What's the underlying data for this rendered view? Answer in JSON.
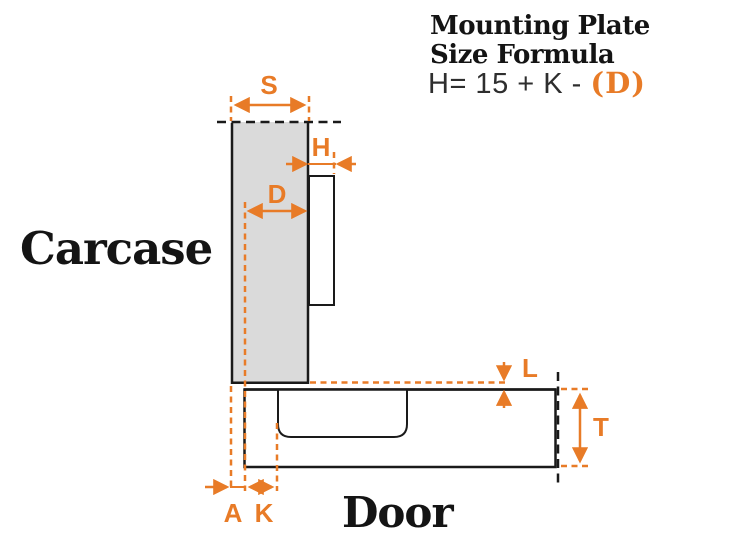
{
  "header": {
    "title_line1": "Mounting Plate",
    "title_line2": "Size Formula",
    "formula_main": "H= 15 + K - ",
    "formula_highlight": "(D)"
  },
  "diagram": {
    "carcase_label": "Carcase",
    "door_label": "Door",
    "dims": {
      "s": "S",
      "h": "H",
      "d": "D",
      "l": "L",
      "t": "T",
      "a": "A",
      "k": "K"
    }
  },
  "colors": {
    "accent_orange": "#E87B27",
    "carcase_gray": "#DADADA",
    "door_tan": "#F2E6CA",
    "outline": "#1A1A1A",
    "formula_gray": "#2E2E2E",
    "text_black": "#141414"
  }
}
